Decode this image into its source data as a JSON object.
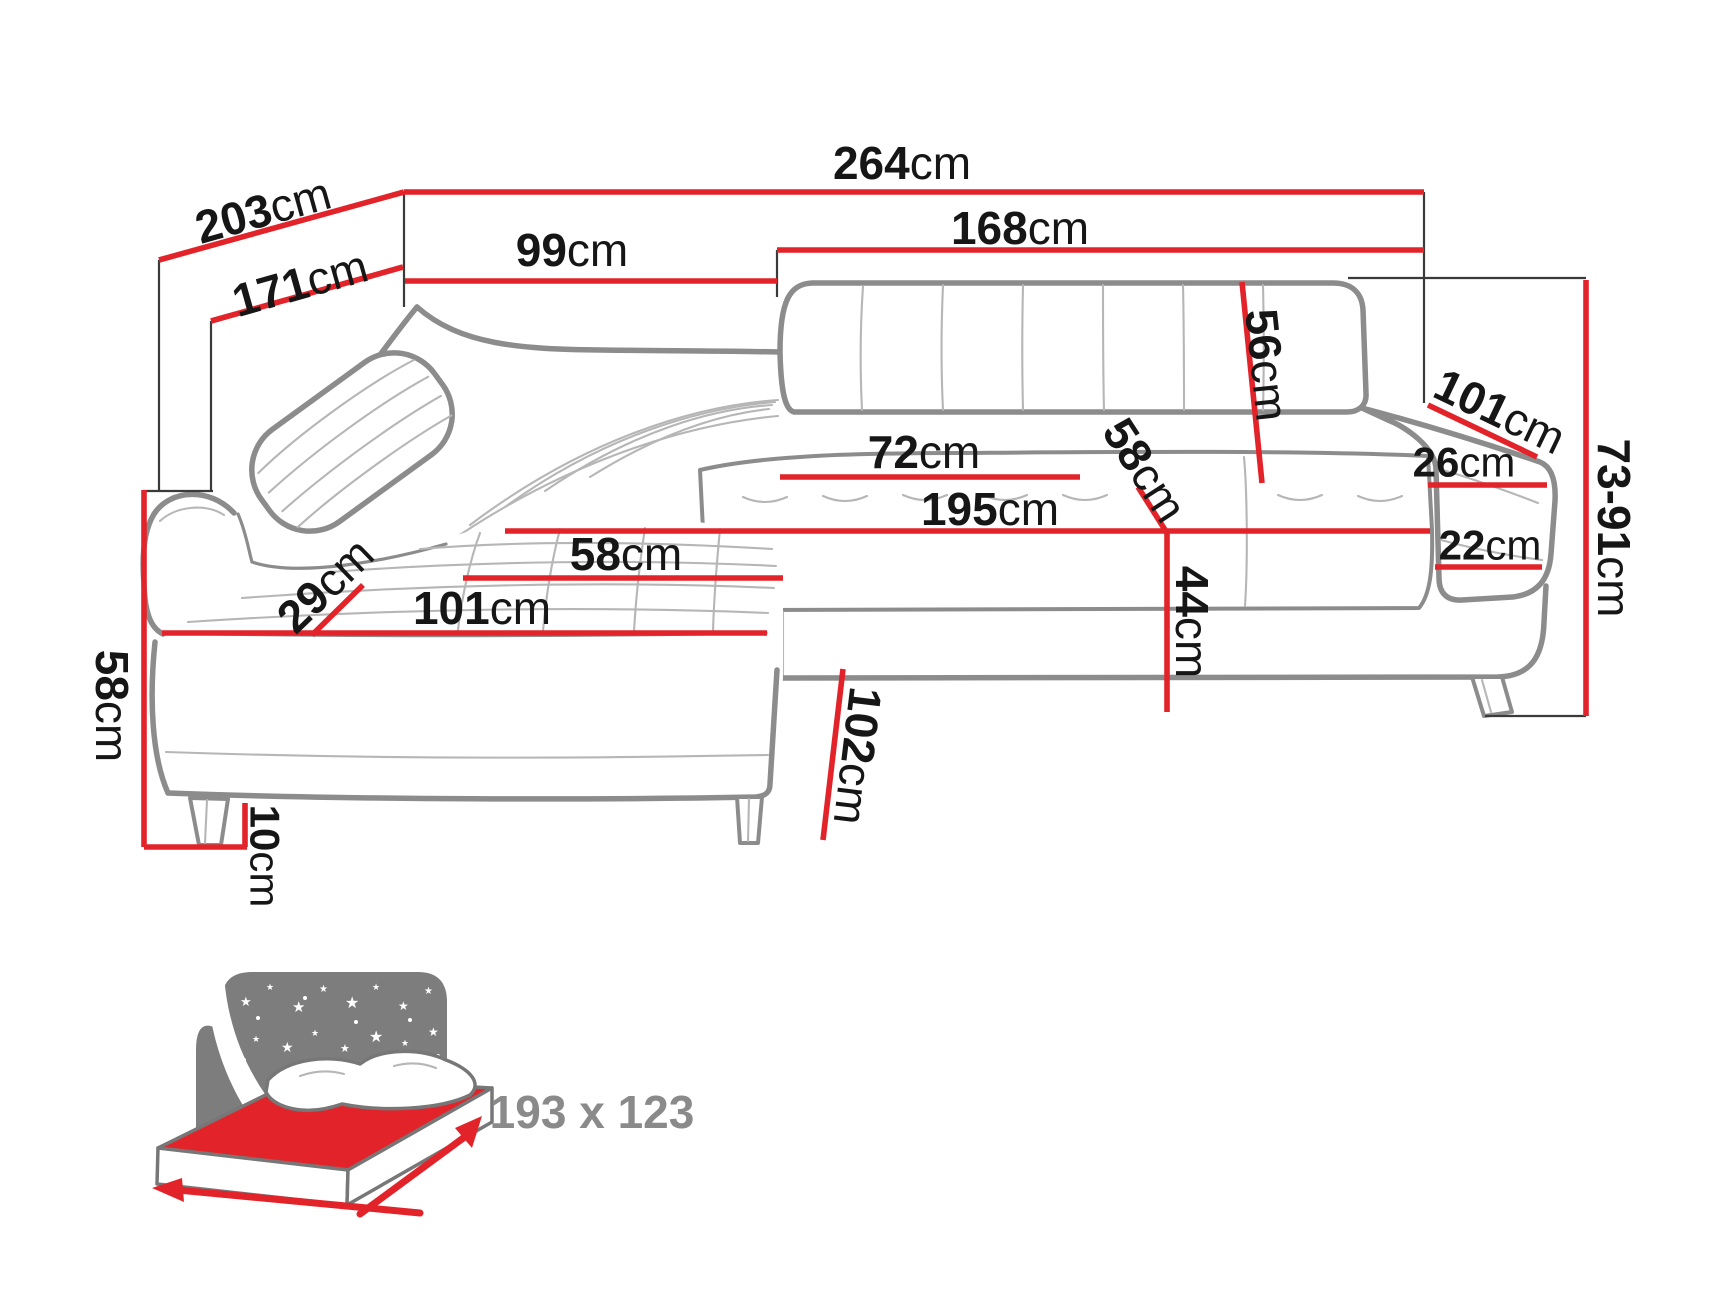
{
  "diagram_title": "corner-sofa-dimensions",
  "unit": "cm",
  "dimensions": {
    "overall_width": {
      "value": "264",
      "unit": "cm"
    },
    "depth_total": {
      "value": "203",
      "unit": "cm"
    },
    "depth_inner": {
      "value": "171",
      "unit": "cm"
    },
    "corner_back_width": {
      "value": "99",
      "unit": "cm"
    },
    "sofa_back_width": {
      "value": "168",
      "unit": "cm"
    },
    "backrest_height": {
      "value": "56",
      "unit": "cm"
    },
    "armrest_outer_length": {
      "value": "101",
      "unit": "cm"
    },
    "armrest_top_width": {
      "value": "26",
      "unit": "cm"
    },
    "height_range": {
      "value": "73-91",
      "unit": "cm"
    },
    "armrest_front_height": {
      "value": "22",
      "unit": "cm"
    },
    "seat_back_width": {
      "value": "72",
      "unit": "cm"
    },
    "seat_depth_right": {
      "value": "58",
      "unit": "cm"
    },
    "seat_length": {
      "value": "195",
      "unit": "cm"
    },
    "seat_height": {
      "value": "44",
      "unit": "cm"
    },
    "corner_seat_width": {
      "value": "58",
      "unit": "cm"
    },
    "corner_seat_diagonal": {
      "value": "29",
      "unit": "cm"
    },
    "chaise_front_length": {
      "value": "101",
      "unit": "cm"
    },
    "side_height": {
      "value": "58",
      "unit": "cm"
    },
    "leg_height": {
      "value": "10",
      "unit": "cm"
    },
    "chaise_depth": {
      "value": "102",
      "unit": "cm"
    }
  },
  "sleeping_area": {
    "label": "193 x 123"
  },
  "colors": {
    "dimension_red": "#e2242a",
    "outline_gray": "#8c8c8c",
    "seam_gray": "#b6b6b6",
    "label_black": "#161616",
    "icon_gray": "#7d7d7d",
    "sleeping_text_gray": "#8a8a8a"
  }
}
